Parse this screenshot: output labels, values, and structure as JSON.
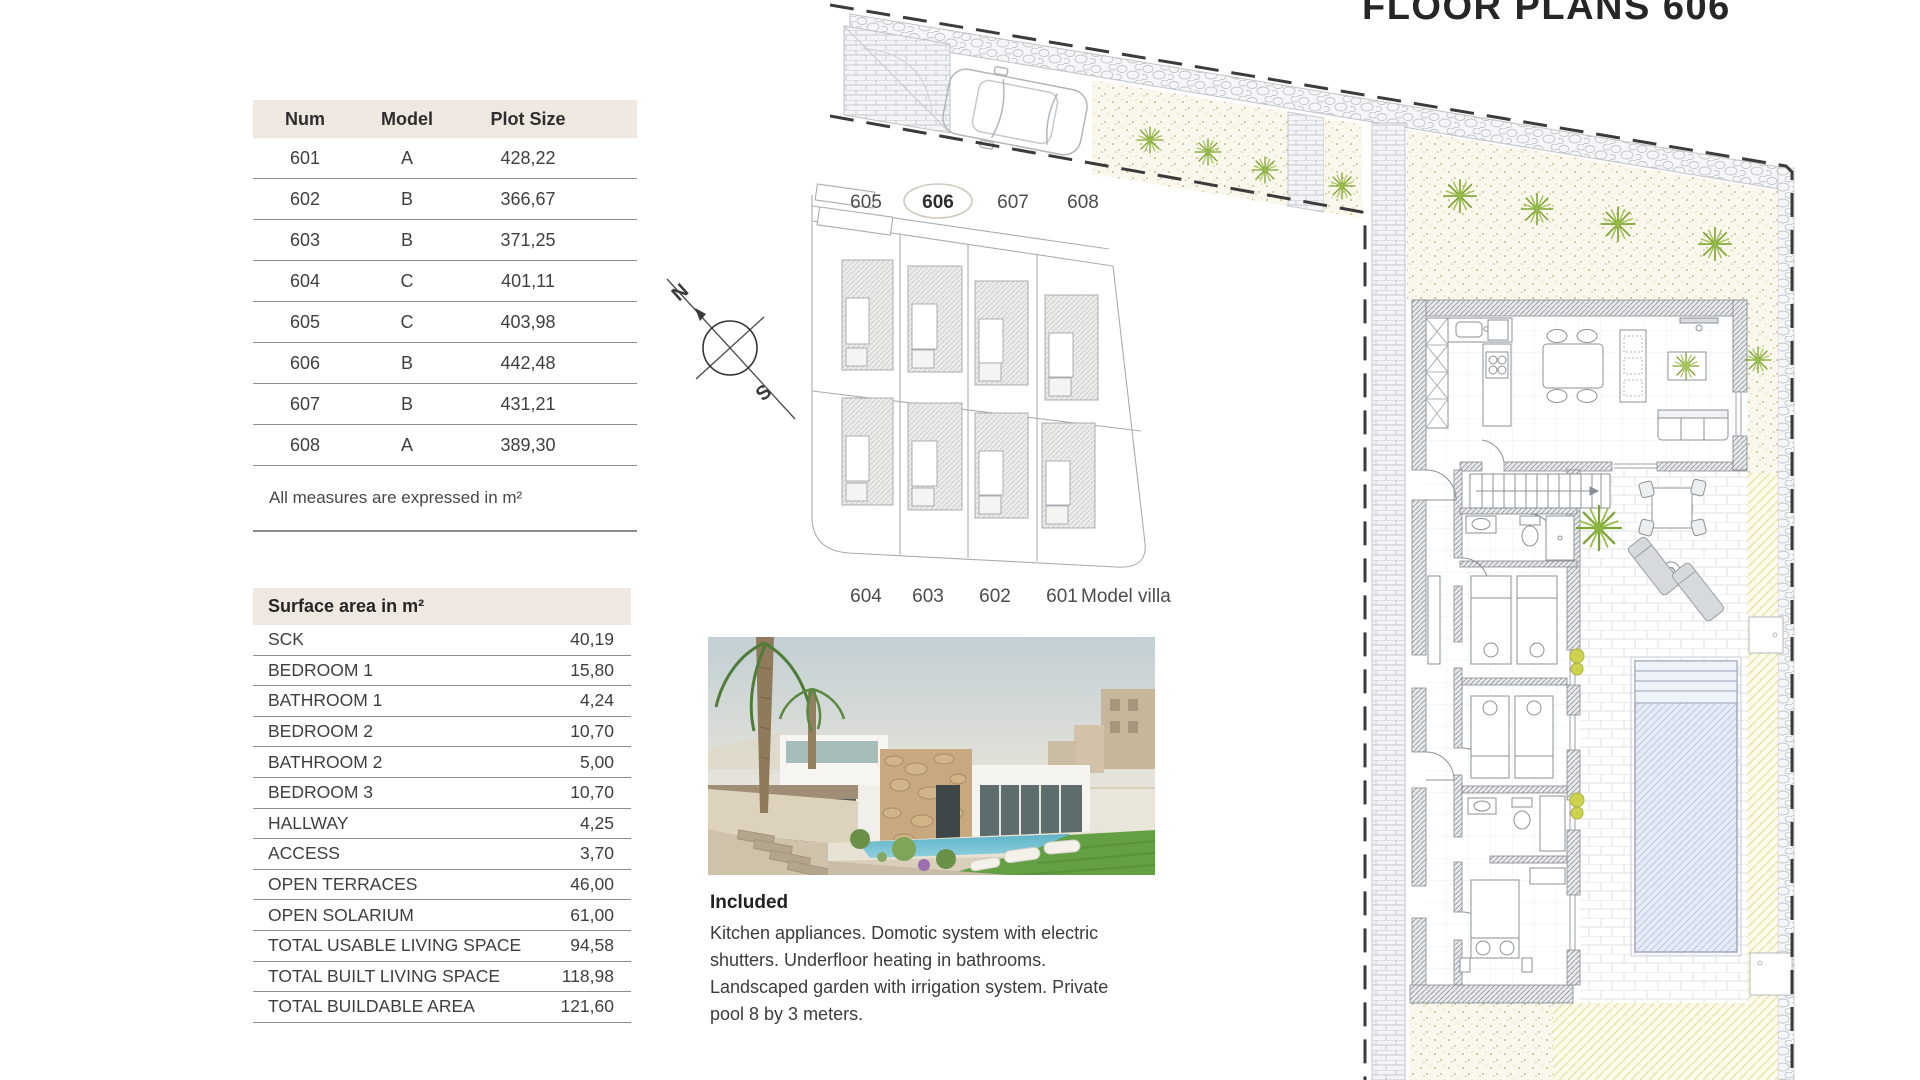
{
  "page": {
    "title": "FLOOR PLANS 606"
  },
  "plot_table": {
    "headers": {
      "num": "Num",
      "model": "Model",
      "plot_size": "Plot Size"
    },
    "rows": [
      {
        "num": "601",
        "model": "A",
        "plot_size": "428,22"
      },
      {
        "num": "602",
        "model": "B",
        "plot_size": "366,67"
      },
      {
        "num": "603",
        "model": "B",
        "plot_size": "371,25"
      },
      {
        "num": "604",
        "model": "C",
        "plot_size": "401,11"
      },
      {
        "num": "605",
        "model": "C",
        "plot_size": "403,98"
      },
      {
        "num": "606",
        "model": "B",
        "plot_size": "442,48"
      },
      {
        "num": "607",
        "model": "B",
        "plot_size": "431,21"
      },
      {
        "num": "608",
        "model": "A",
        "plot_size": "389,30"
      }
    ],
    "note": "All measures are expressed in m²"
  },
  "surface_table": {
    "title": "Surface area in m²",
    "rows": [
      {
        "label": "SCK",
        "value": "40,19"
      },
      {
        "label": "BEDROOM 1",
        "value": "15,80"
      },
      {
        "label": "BATHROOM 1",
        "value": "4,24"
      },
      {
        "label": "BEDROOM 2",
        "value": "10,70"
      },
      {
        "label": "BATHROOM 2",
        "value": "5,00"
      },
      {
        "label": "BEDROOM 3",
        "value": "10,70"
      },
      {
        "label": "HALLWAY",
        "value": "4,25"
      },
      {
        "label": "ACCESS",
        "value": "3,70"
      },
      {
        "label": "OPEN TERRACES",
        "value": "46,00"
      },
      {
        "label": "OPEN SOLARIUM",
        "value": "61,00"
      },
      {
        "label": "TOTAL USABLE LIVING SPACE",
        "value": "94,58"
      },
      {
        "label": "TOTAL BUILT LIVING SPACE",
        "value": "118,98"
      },
      {
        "label": "TOTAL BUILDABLE AREA",
        "value": "121,60"
      }
    ]
  },
  "site_plan": {
    "top_labels": [
      "605",
      "606",
      "607",
      "608"
    ],
    "bottom_labels": [
      "604",
      "603",
      "602",
      "601"
    ],
    "model_villa_label": "Model villa",
    "highlighted_plot": "606",
    "compass": {
      "north_label": "N",
      "south_label": "S"
    }
  },
  "included": {
    "heading": "Included",
    "body": "Kitchen appliances. Domotic system with electric shutters. Underfloor heating in bathrooms. Landscaped garden with irrigation system. Private pool 8 by 3 meters."
  },
  "colors": {
    "table_header_bg": "#efe8e1",
    "table_line": "#8c8c8c",
    "text": "#3f3f3f",
    "boundary_dash": "#3b3b3b",
    "gravel_dot": "#cdc493",
    "lawn_hatch": "#e8e2ab",
    "pool_fill": "#e7ecf6",
    "plant_green": "#7da432"
  }
}
